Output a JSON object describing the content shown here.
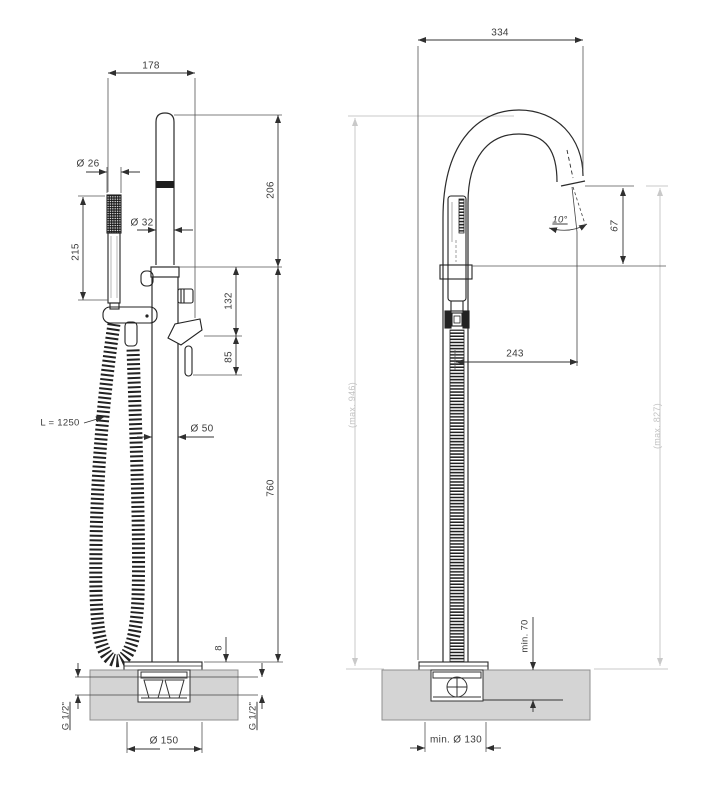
{
  "drawing": {
    "type": "technical-dimension-drawing",
    "subject": "freestanding bath mixer with hand shower",
    "views": [
      "front",
      "side"
    ]
  },
  "dims": {
    "front": {
      "spout_offset": "178",
      "handset_diameter": "Ø 26",
      "handset_length": "215",
      "riser_diameter": "Ø 32",
      "spout_height": "206",
      "diverter_height": "132",
      "lever_height": "85",
      "hose_length": "L = 1250",
      "column_diameter": "Ø 50",
      "column_height": "760",
      "base_plate_thickness": "8",
      "inlet_left": "G 1/2\"",
      "inlet_right": "G 1/2\"",
      "base_diameter": "Ø 150"
    },
    "side": {
      "reach_total": "334",
      "spout_angle": "10°",
      "spout_drop": "67",
      "spout_reach": "243",
      "max_height": "(max. 946)",
      "max_spout_height": "(max. 827)",
      "min_recess_depth": "min. 70",
      "min_base_diameter": "min. Ø 130"
    }
  }
}
